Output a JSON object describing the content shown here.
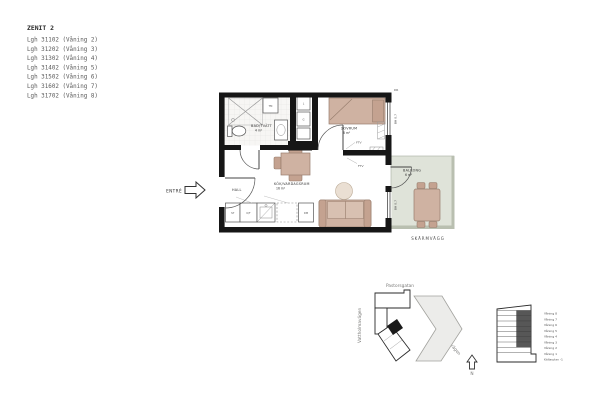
{
  "legend": {
    "title": "ZENIT 2",
    "apartments": [
      "Lgh 31102 (Våning 2)",
      "Lgh 31202 (Våning 3)",
      "Lgh 31302 (Våning 4)",
      "Lgh 31402 (Våning 5)",
      "Lgh 31502 (Våning 6)",
      "Lgh 31602 (Våning 7)",
      "Lgh 31702 (Våning 8)"
    ]
  },
  "floorplan": {
    "entrance_label": "ENTRÉ",
    "rooms": {
      "hall": {
        "name": "HALL"
      },
      "bathroom": {
        "name": "BAD/TVÄTT",
        "area": "4 m²"
      },
      "bedroom": {
        "name": "SOVRUM",
        "area": "8 m²"
      },
      "kitchen_living": {
        "name": "KÖK/VARDAGSRUM",
        "area": "16 m²"
      },
      "balcony": {
        "name": "BALKONG",
        "area": "6 m²"
      }
    },
    "annotations": {
      "screen_wall": "SKÄRMVÄGG",
      "window_sill_height": "BH 0,7",
      "tv_outlet": "FTV",
      "door_mark": "DR"
    },
    "fixtures": {
      "washing_machine": "TM",
      "cleaning_cabinet": "ST",
      "fridge_freezer": "K/F",
      "dishwasher": "DM",
      "linen_cabinet": "L",
      "wardrobe": "G"
    },
    "colors": {
      "wall": "#161616",
      "furniture": "#cfb2a2",
      "balcony_floor": "#dfe3d9"
    }
  },
  "siteplan": {
    "streets": {
      "north": "Pastorsgatan",
      "west": "Vattholmavägen",
      "east": "Åbyvägen"
    },
    "compass": "N"
  },
  "elevation": {
    "floors": [
      "Våning 8",
      "Våning 7",
      "Våning 6",
      "Våning 5",
      "Våning 4",
      "Våning 3",
      "Våning 2",
      "Våning 1",
      "Källarplan -1"
    ]
  }
}
